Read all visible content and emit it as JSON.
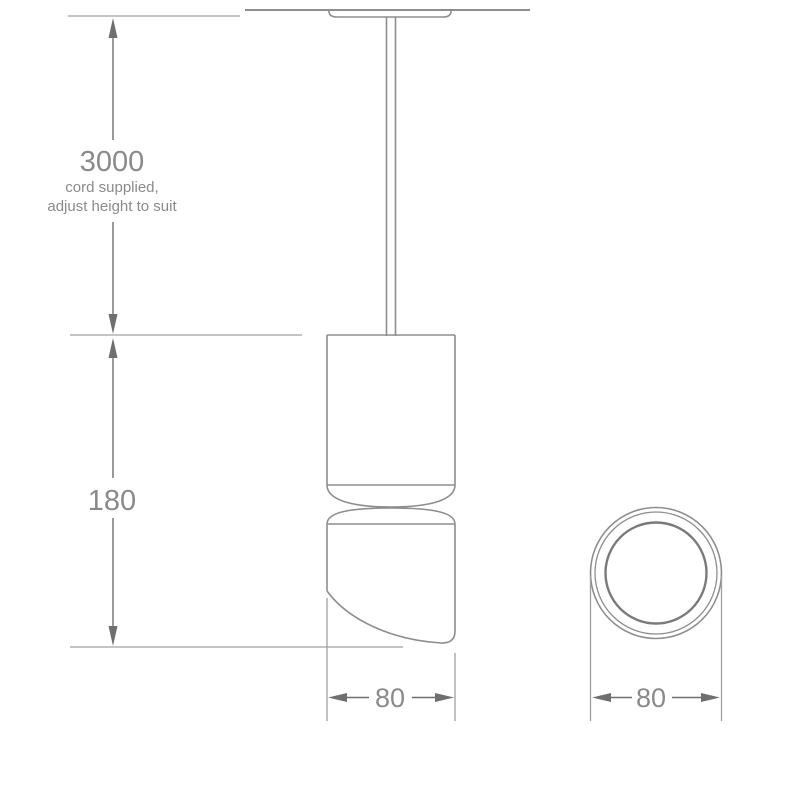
{
  "colors": {
    "line_color": "#8e8e8e",
    "dim_line_color": "#6f6f6f",
    "ext_line_color": "#a0a0a0",
    "lens_color": "#7a7a7a",
    "text_color": "#8a8a8a",
    "background": "#ffffff"
  },
  "side_view": {
    "cord_dimension": {
      "value": "3000",
      "note_line1": "cord supplied,",
      "note_line2": "adjust height to suit"
    },
    "height_dimension": "180",
    "width_dimension": "80"
  },
  "end_view": {
    "diameter_dimension": "80"
  }
}
